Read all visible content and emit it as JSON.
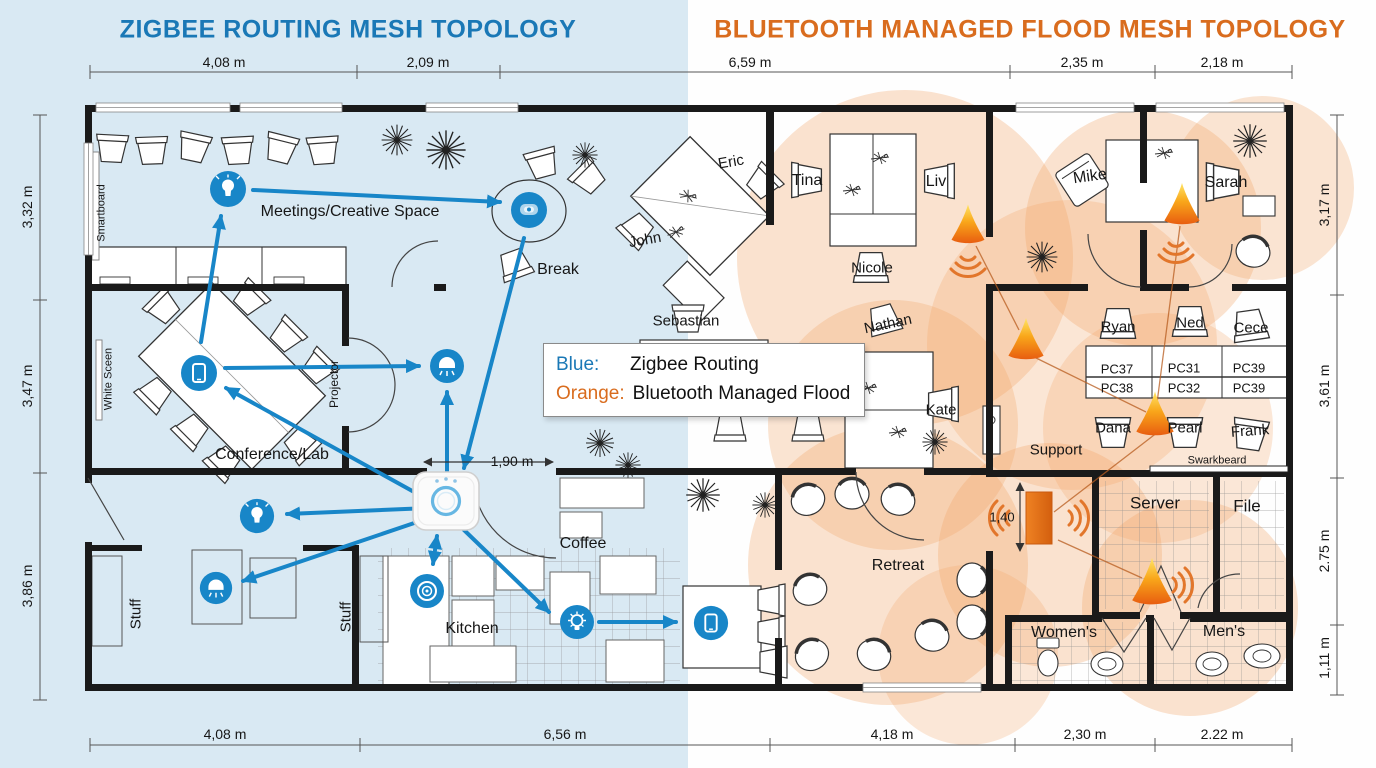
{
  "titles": {
    "zigbee": "ZIGBEE ROUTING MESH TOPOLOGY",
    "bluetooth": "BLUETOOTH MANAGED FLOOD MESH TOPOLOGY"
  },
  "legend": {
    "blue_key": "Blue:",
    "blue_value": "Zigbee Routing",
    "orange_key": "Orange:",
    "orange_value": "Bluetooth Managed Flood"
  },
  "dims": {
    "top": [
      "4,08 m",
      "2,09 m",
      "6,59 m",
      "2,35 m",
      "2,18 m"
    ],
    "bottom": [
      "4,08 m",
      "6,56 m",
      "4,18 m",
      "2,30 m",
      "2.22 m"
    ],
    "left": [
      "3,32 m",
      "3,47 m",
      "3,86 m"
    ],
    "right": [
      "3,17 m",
      "3,61 m",
      "2.75 m",
      "1,11 m"
    ],
    "hub_clearance": "1,90 m",
    "door_width": "1,40"
  },
  "rooms": {
    "meetings": "Meetings/Creative Space",
    "break_room": "Break",
    "conference": "Conference/Lab",
    "coffee": "Coffee",
    "kitchen": "Kitchen",
    "stuff_a": "Stuff",
    "stuff_b": "Stuff",
    "retreat": "Retreat",
    "support": "Support",
    "server": "Server",
    "file": "File",
    "womens": "Women's",
    "mens": "Men's",
    "smartboard": "Smartboard",
    "white_screen": "White Sceen",
    "projector": "Projector",
    "swarkbeard": "Swarkbeard"
  },
  "people": {
    "eric": "Eric",
    "john": "John",
    "tina": "Tina",
    "liv": "Liv",
    "nicole": "Nicole",
    "sebastian": "Sebastian",
    "nathan": "Nathan",
    "thomas": "Thomas",
    "linda": "Linda",
    "kate": "Kate",
    "mike": "Mike",
    "sarah": "Sarah",
    "ryan": "Ryan",
    "ned": "Ned",
    "cece": "Cece",
    "dana": "Dana",
    "pearl": "Pearl",
    "frank": "Frank"
  },
  "pcs": {
    "row1": [
      "PC37",
      "PC31",
      "PC39"
    ],
    "row2": [
      "PC38",
      "PC32",
      "PC39"
    ]
  },
  "colors": {
    "zigbee_blue": "#1886c8",
    "bluetooth_orange": "#e0701f",
    "title_blue": "#1a78b6",
    "title_orange": "#d96c1e",
    "left_bg": "#d9e9f3",
    "coverage": "#f2a262"
  }
}
